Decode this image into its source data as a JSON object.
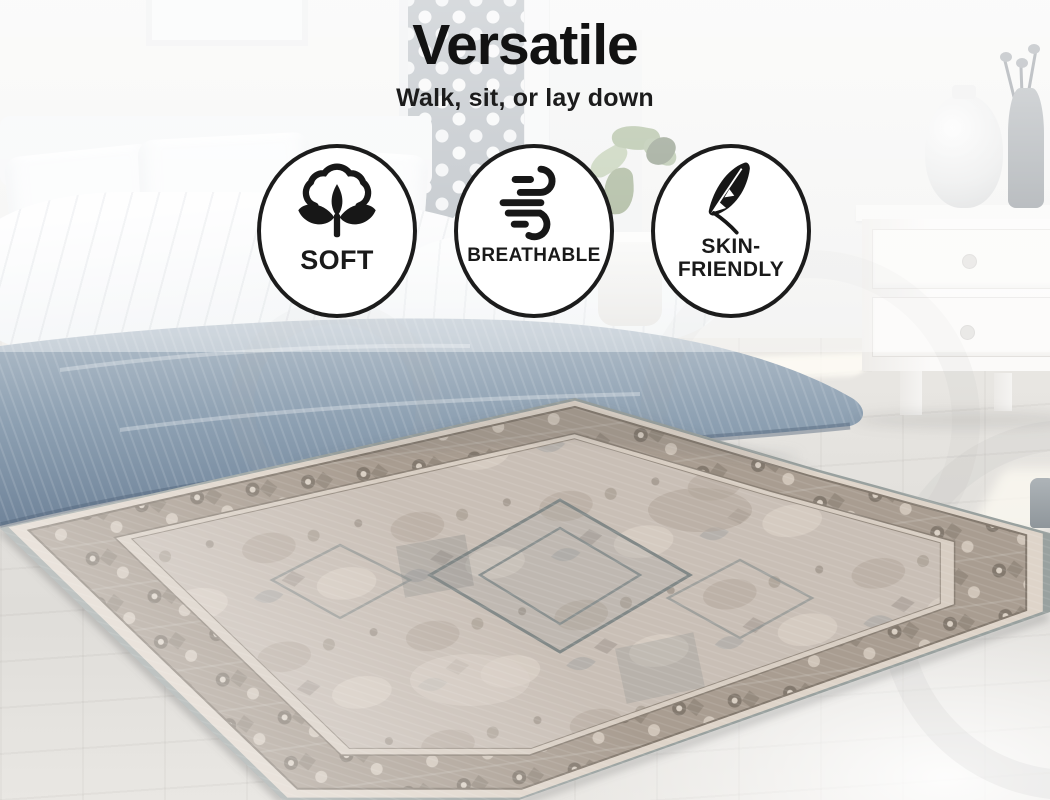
{
  "header": {
    "title": "Versatile",
    "subtitle": "Walk, sit, or lay down"
  },
  "badges": [
    {
      "icon": "cotton-flower-icon",
      "lines": [
        "SOFT"
      ]
    },
    {
      "icon": "wind-icon",
      "lines": [
        "BREATHABLE"
      ]
    },
    {
      "icon": "feather-icon",
      "lines": [
        "SKIN-",
        "FRIENDLY"
      ]
    }
  ],
  "colors": {
    "headline_text": "#121212",
    "badge_background": "#ffffff",
    "badge_border": "#1c1c1c",
    "badge_icon": "#171717",
    "quilt_blue": "#8196a9",
    "rug_field": "#c8beb5",
    "rug_border_band": "#a99d91",
    "rug_binding": "#99a19f",
    "floor": "#e4e2de",
    "curtain_pattern": "#9ba3ab"
  }
}
